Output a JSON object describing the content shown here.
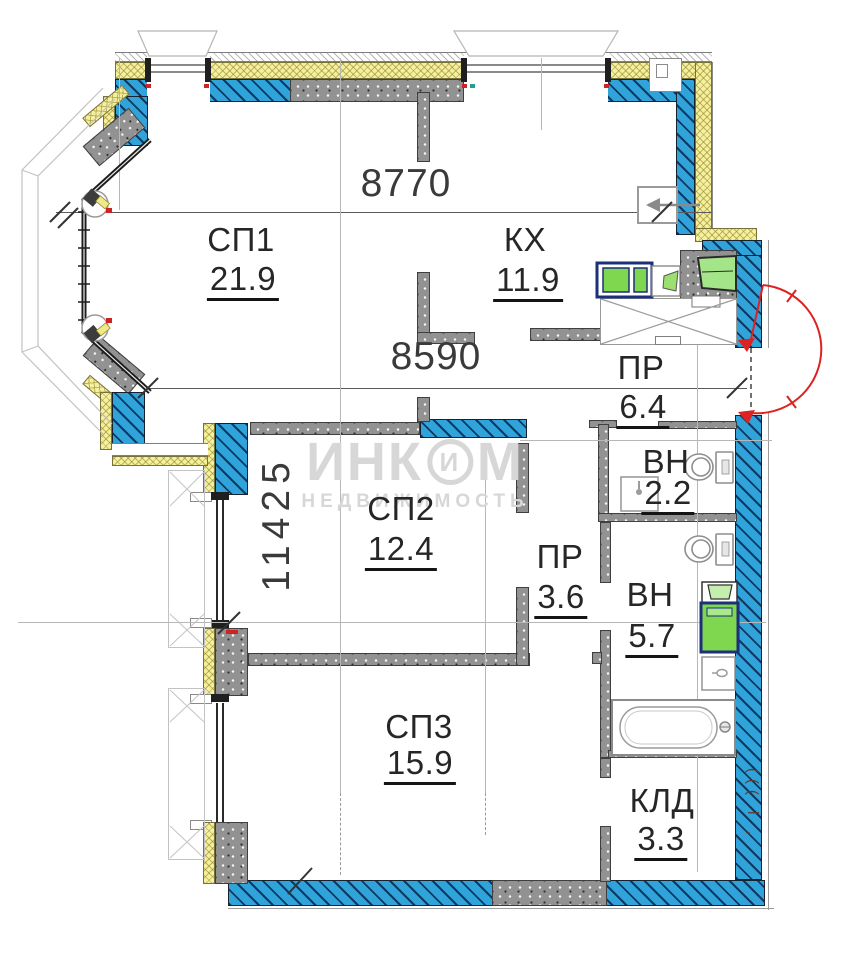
{
  "title": "Apartment floor plan",
  "watermark": {
    "brand_pre": "ИНК",
    "brand_logo": "И",
    "brand_post": "М",
    "subtitle": "НЕДВИЖИМОСТЬ"
  },
  "rooms": [
    {
      "name": "СП1",
      "area": "21.9"
    },
    {
      "name": "КХ",
      "area": "11.9"
    },
    {
      "name": "ПР",
      "area": "6.4"
    },
    {
      "name": "ВН",
      "area": "2.2"
    },
    {
      "name": "СП2",
      "area": "12.4"
    },
    {
      "name": "ПР",
      "area": "3.6"
    },
    {
      "name": "ВН",
      "area": "5.7"
    },
    {
      "name": "СП3",
      "area": "15.9"
    },
    {
      "name": "КЛД",
      "area": "3.3"
    }
  ],
  "dimensions": {
    "top_width": "8770",
    "inner_width": "8590",
    "left_height": "11425"
  },
  "edge_clipped_text": "((( l ,",
  "icons": {
    "entrance": "door-swing",
    "bathroom_small": [
      "toilet",
      "sink"
    ],
    "bathroom_large": [
      "toilet",
      "washing-machine",
      "sink",
      "bathtub"
    ],
    "kitchen": [
      "stove",
      "counter-sink",
      "kitchen-sink",
      "ventilation-grille",
      "shaft-cross"
    ]
  },
  "colors": {
    "masonry_blue": "#2fa3da",
    "insulation_yellow": "#f4f0a2",
    "concrete_gray": "#929292",
    "fixture_green": "#7fd74f",
    "door_swing_red": "#dd2222",
    "watermark_gray": "#d7d7d7"
  }
}
